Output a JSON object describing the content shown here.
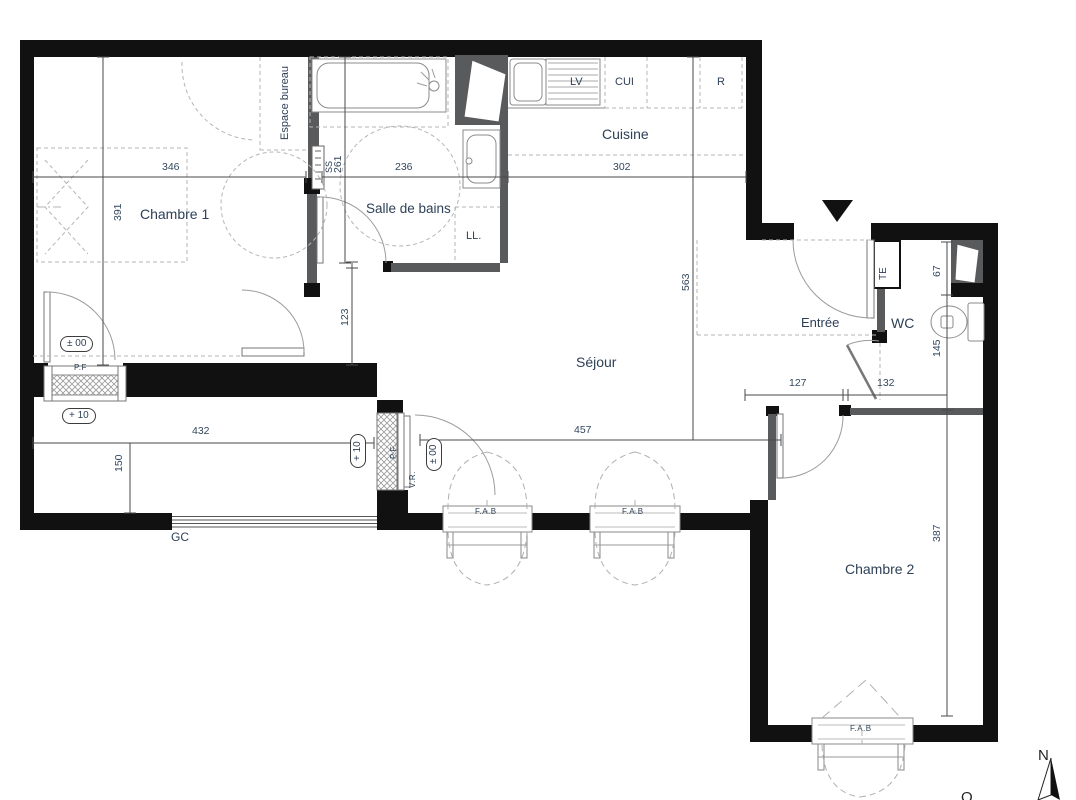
{
  "title": "Plan d'appartement",
  "colors": {
    "wall": "#111111",
    "interior_wall": "#595a5c",
    "text": "#2e4057",
    "dim_line": "#4a4a4a",
    "dash": "#b5b5b5",
    "arc": "#9c9c9c"
  },
  "rooms": {
    "chambre1": "Chambre 1",
    "salle_de_bains": "Salle de bains",
    "cuisine": "Cuisine",
    "sejour": "Séjour",
    "entree": "Entrée",
    "wc": "WC",
    "chambre2": "Chambre 2"
  },
  "zones": {
    "espace_bureau": "Espace bureau"
  },
  "equipment": {
    "lv": "LV",
    "cui": "CUI",
    "r": "R",
    "ll": "LL.",
    "ss": "SS",
    "te": "TE",
    "gc": "GC"
  },
  "openings": {
    "pf_chambre1": "P.F",
    "pf_sejour": "P.F.",
    "vr": "V.R.",
    "fab_sejour_1": "F.A.B",
    "fab_sejour_2": "F.A.B",
    "fab_chambre2": "F.A.B"
  },
  "dimensions_cm": {
    "chambre1_width": "346",
    "chambre1_depth": "391",
    "sdb_height": "261",
    "sdb_width": "236",
    "degagement": "123",
    "cuisine_width": "302",
    "sejour_depth": "563",
    "sejour_width": "457",
    "balcon_width": "432",
    "balcon_depth": "150",
    "entree_seg1": "127",
    "entree_seg2": "132",
    "wc_seg": "67",
    "wc_depth": "145",
    "chambre2_depth": "387"
  },
  "levels": {
    "chambre1_pf": "± 00",
    "balcon_1": "+ 10",
    "balcon_2": "+ 10",
    "sejour_pf": "± 00"
  },
  "compass": {
    "north": "N",
    "west": "O"
  }
}
